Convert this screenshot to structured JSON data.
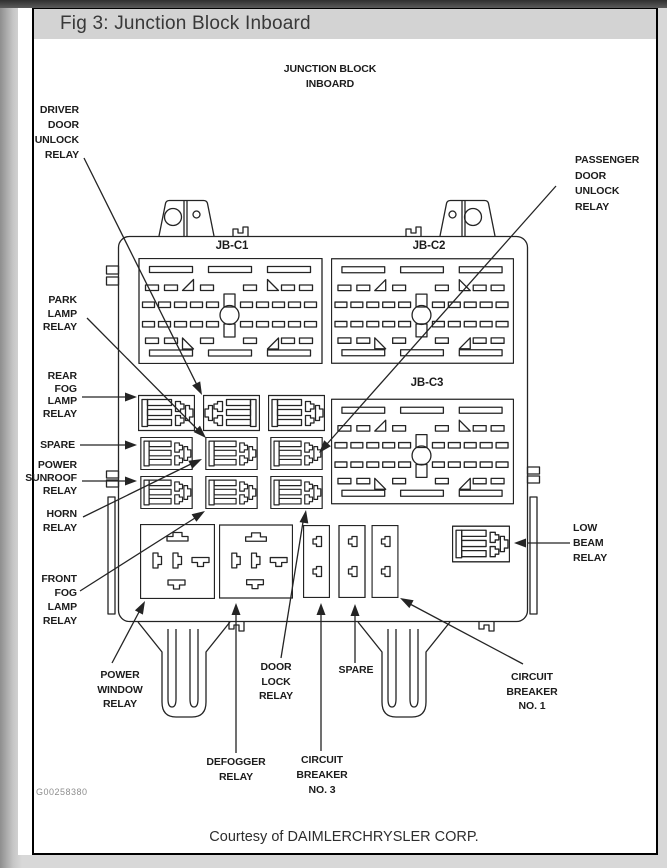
{
  "window": {
    "title_bar": "Fig 3: Junction Block Inboard"
  },
  "figure": {
    "heading": "JUNCTION BLOCK\nINBOARD",
    "code": "G00258380",
    "courtesy": "Courtesy of DAIMLERCHRYSLER CORP.",
    "connector_labels": {
      "jb_c1": "JB-C1",
      "jb_c2": "JB-C2",
      "jb_c3": "JB-C3"
    },
    "callouts": {
      "driver_door": "DRIVER\nDOOR\nUNLOCK\nRELAY",
      "passenger_door": "PASSENGER\nDOOR\nUNLOCK\nRELAY",
      "park_lamp": "PARK\nLAMP\nRELAY",
      "rear_fog": "REAR\nFOG\nLAMP\nRELAY",
      "spare_left": "SPARE",
      "power_sunroof": "POWER\nSUNROOF\nRELAY",
      "horn": "HORN\nRELAY",
      "front_fog": "FRONT\nFOG\nLAMP\nRELAY",
      "low_beam": "LOW\nBEAM\nRELAY",
      "power_window": "POWER\nWINDOW\nRELAY",
      "door_lock": "DOOR\nLOCK\nRELAY",
      "spare_bottom": "SPARE",
      "circuit_breaker_1": "CIRCUIT\nBREAKER\nNO. 1",
      "defogger": "DEFOGGER\nRELAY",
      "circuit_breaker_3": "CIRCUIT\nBREAKER\nNO. 3"
    },
    "colors": {
      "titlebar_bg": "#d3d3d3",
      "line_art": "#242424",
      "code_gray": "#8d8d8d"
    }
  }
}
